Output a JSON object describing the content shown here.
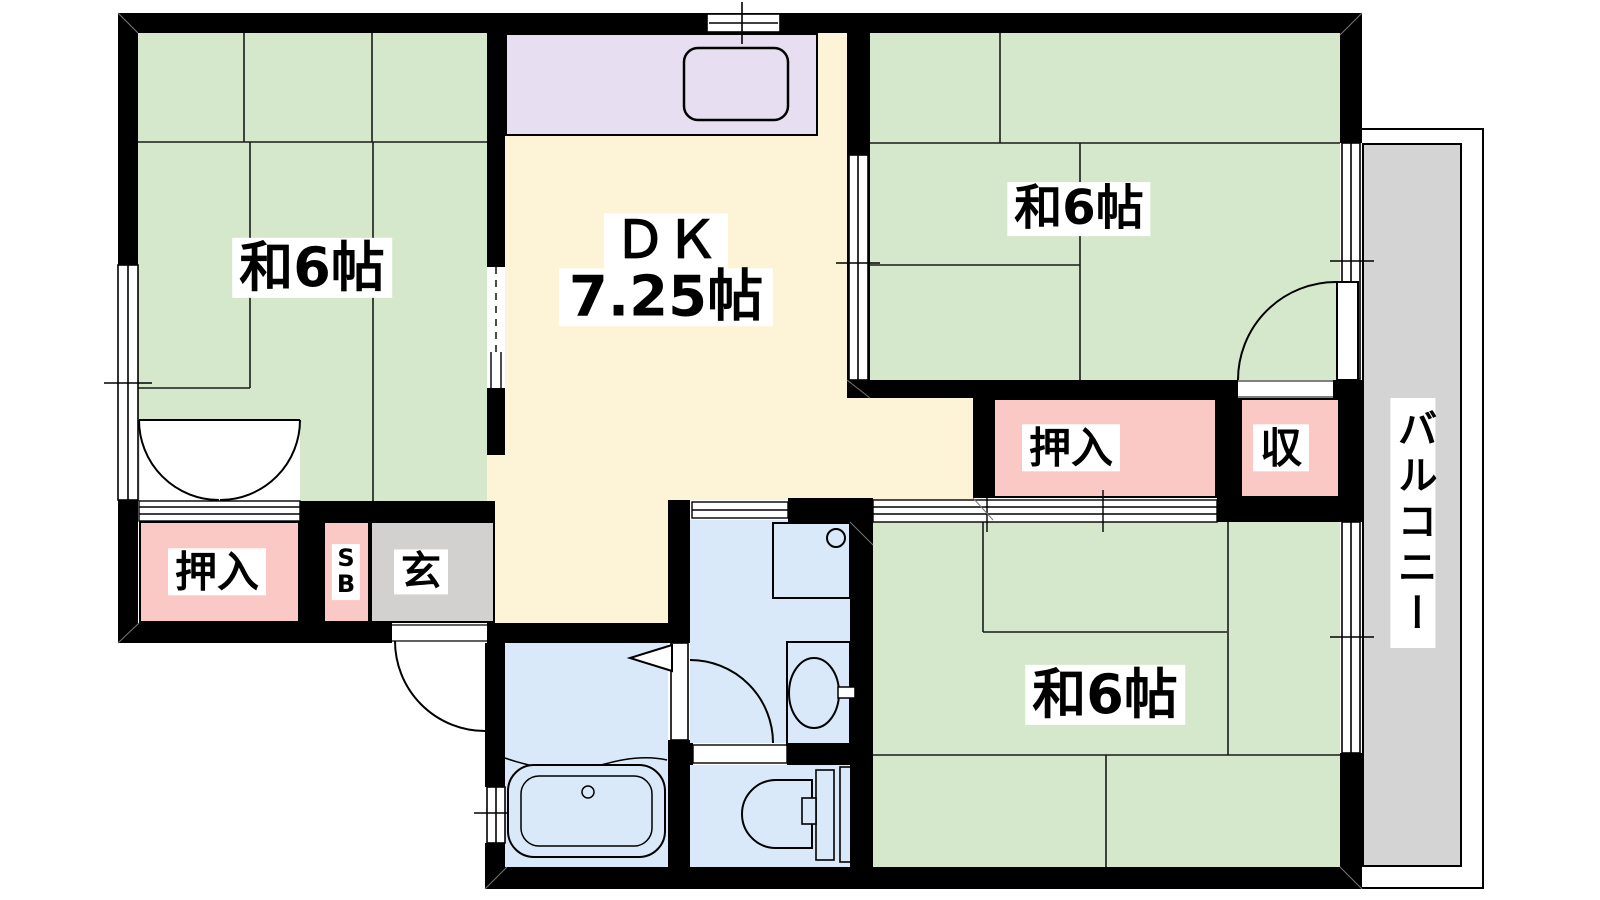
{
  "floor_plan": {
    "type": "japanese-apartment-3DK-floorplan",
    "labels": {
      "room_top_left": "和6帖",
      "room_top_right": "和6帖",
      "room_bottom_right": "和6帖",
      "dk_line1": "ＤＫ",
      "dk_line2": "7.25帖",
      "closet_bottom_left": "押入",
      "closet_mid_right": "押入",
      "storage": "収",
      "shoebox_line1": "S",
      "shoebox_line2": "B",
      "entrance": "玄",
      "balcony": "バルコニー"
    },
    "colors": {
      "tatami_green": "#d5e8cc",
      "dk_cream": "#fdf3d6",
      "kitchen_purple": "#e7def1",
      "closet_pink": "#fac9c5",
      "entrance_gray": "#d2d1cf",
      "balcony_gray": "#d4d4d4",
      "wet_area_blue": "#d9e9f9",
      "wall_black": "#000000",
      "background": "#ffffff"
    }
  }
}
